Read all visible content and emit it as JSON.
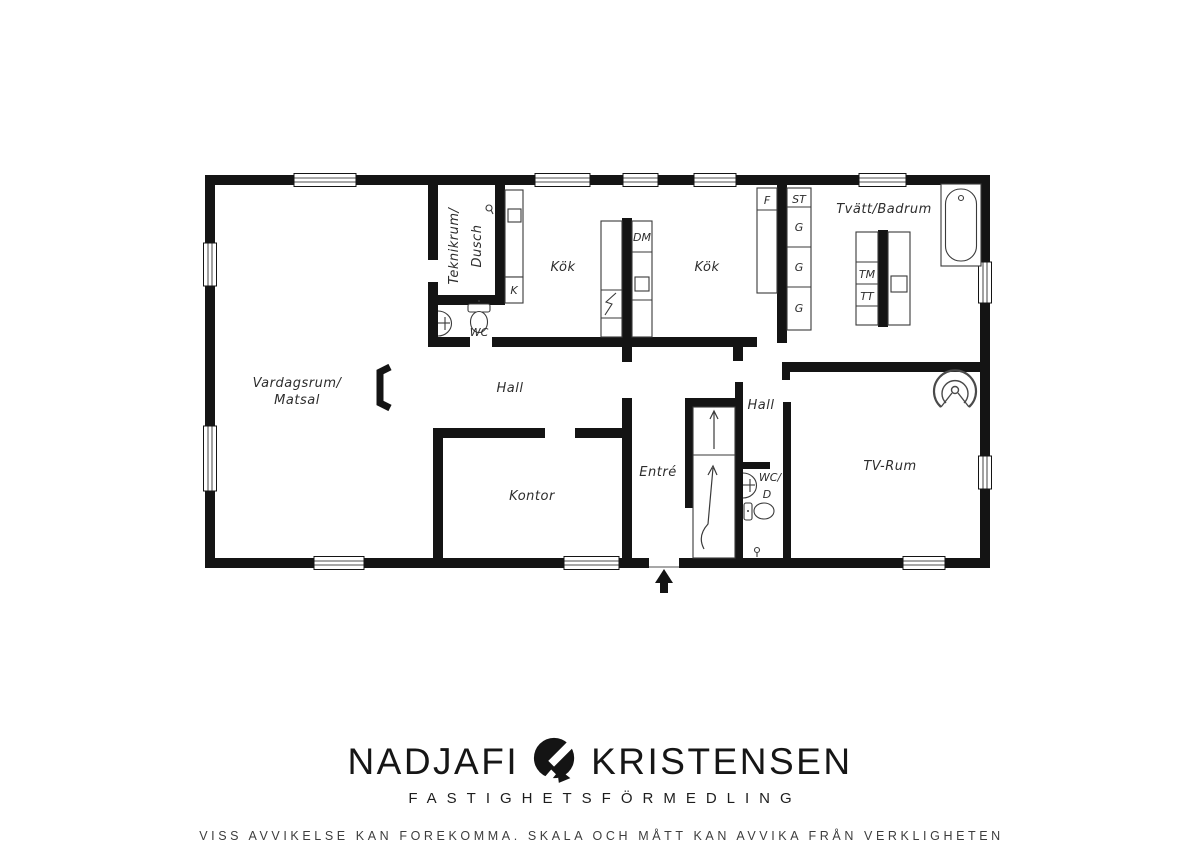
{
  "plan": {
    "rooms": {
      "livingroom_line1": "Vardagsrum/",
      "livingroom_line2": "Matsal",
      "techroom_line1": "Teknikrum/",
      "techroom_line2": "Dusch",
      "wc": "WC",
      "kitchen_left": "Kök",
      "kitchen_right": "Kök",
      "laundry_bathroom": "Tvätt/Badrum",
      "hall_left": "Hall",
      "hall_right": "Hall",
      "office": "Kontor",
      "entry": "Entré",
      "wc2_line1": "WC/",
      "wc2_line2": "D",
      "tv_room": "TV-Rum"
    },
    "fixtures": {
      "dishwasher": "DM",
      "fridge_small": "K",
      "freezer": "F",
      "cleaning_cabinet": "ST",
      "wardrobe1": "G",
      "wardrobe2": "G",
      "wardrobe3": "G",
      "washing_machine": "TM",
      "dryer": "TT"
    }
  },
  "footer": {
    "brand_first": "NADJAFI",
    "brand_second": "KRISTENSEN",
    "subtitle": "FASTIGHETSFÖRMEDLING",
    "disclaimer": "VISS AVVIKELSE KAN FOREKOMMA. SKALA OCH MÅTT KAN AVVIKA FRÅN VERKLIGHETEN"
  },
  "colors": {
    "wall": "#141414",
    "thin_line": "#3a3a3a",
    "background": "#ffffff",
    "label_text": "#2d2d2d"
  }
}
